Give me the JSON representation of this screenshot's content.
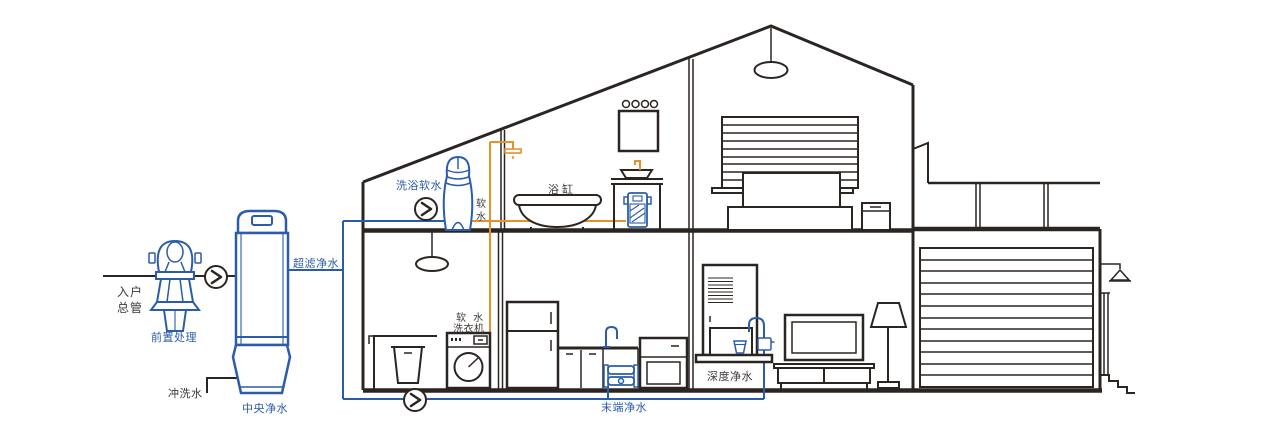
{
  "diagram": {
    "title_hint": "whole-house water purification cutaway diagram",
    "colors": {
      "outline_dark": "#2b2522",
      "device_blue": "#2a5caa",
      "soft_water_orange": "#e8902b",
      "label_dark": "#3f3937",
      "background": "#ffffff"
    },
    "icons": {
      "flow_arrow": "chevron-right-in-circle"
    },
    "labels": {
      "inlet_line1": "入户",
      "inlet_line2": "总管",
      "pre_treatment": "前置处理",
      "flush_water": "冲洗水",
      "central_purification": "中央净水",
      "ultra_filtration": "超滤净水",
      "bath_softening": "洗浴软水",
      "soft_water_char1": "软",
      "soft_water_char2": "水",
      "bathtub": "浴缸",
      "washer_line1": "软 水",
      "washer_line2": "洗衣机",
      "terminal_purification": "末端净水",
      "deep_purification": "深度净水"
    }
  }
}
